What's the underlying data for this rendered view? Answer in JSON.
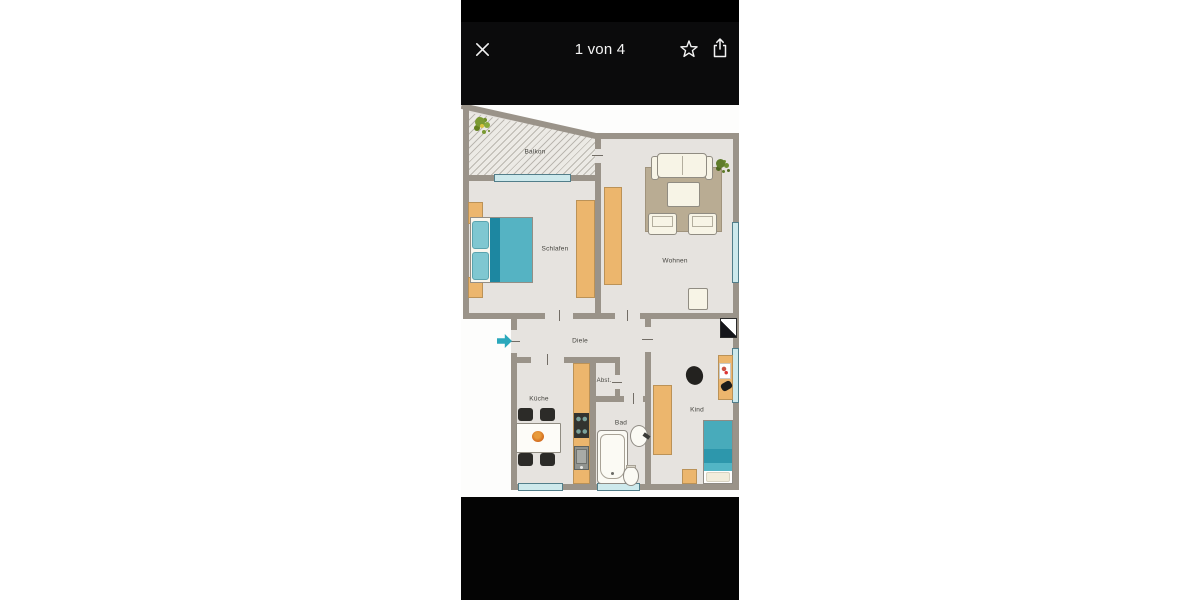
{
  "viewer": {
    "counter": "1 von 4",
    "icons": [
      "close-icon",
      "star-icon",
      "share-icon"
    ]
  },
  "floorplan": {
    "rooms": {
      "balkon": {
        "label": "Balkon"
      },
      "schlafen": {
        "label": "Schlafen"
      },
      "wohnen": {
        "label": "Wohnen"
      },
      "diele": {
        "label": "Diele"
      },
      "abst": {
        "label": "Abst."
      },
      "kueche": {
        "label": "Küche"
      },
      "bad": {
        "label": "Bad"
      },
      "kind": {
        "label": "Kind"
      }
    },
    "colors": {
      "wall": "#9a9389",
      "floor": "#e6e3df",
      "wood_furniture": "#ecb66d",
      "water_teal": "#3aa9ba",
      "window_glass": "#cde9ec",
      "rug": "#b9ac93",
      "header_bg": "#0b0b0c"
    }
  }
}
